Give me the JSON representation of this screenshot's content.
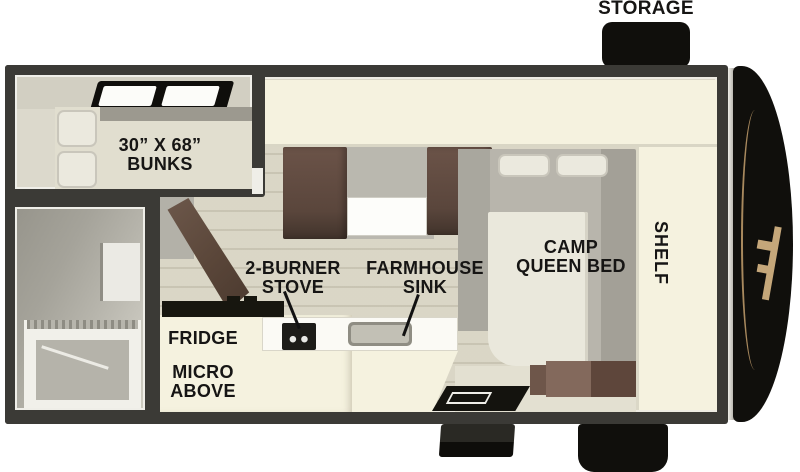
{
  "labels": {
    "storage": "STORAGE",
    "bunks_line1": "30” X 68”",
    "bunks_line2": "BUNKS",
    "stove_line1": "2-BURNER",
    "stove_line2": "STOVE",
    "sink_line1": "FARMHOUSE",
    "sink_line2": "SINK",
    "fridge": "FRIDGE",
    "micro_line1": "MICRO",
    "micro_line2": "ABOVE",
    "bed_line1": "CAMP",
    "bed_line2": "QUEEN BED",
    "shelf": "SHELF"
  },
  "colors": {
    "wall": "#3b3a36",
    "floor": "#d8d4c2",
    "cream": "#f5f2df",
    "cabinet_brown": "#5f4b3e",
    "black": "#100f0c",
    "accent_tan": "#c5a77a",
    "mattress_gray": "#b6b3aa",
    "label_text": "#161514"
  }
}
